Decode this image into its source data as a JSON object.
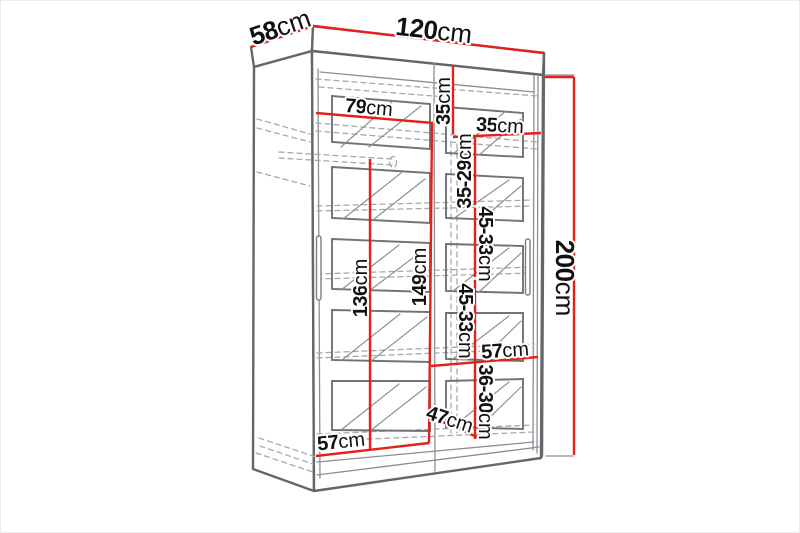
{
  "drawing": {
    "unit": "cm",
    "labels": {
      "depth": {
        "num": "58",
        "unit": "cm"
      },
      "width": {
        "num": "120",
        "unit": "cm"
      },
      "height": {
        "num": "200",
        "unit": "cm"
      },
      "left_interior_width": {
        "num": "79",
        "unit": "cm"
      },
      "top_shelf_height": {
        "num": "35",
        "unit": "cm"
      },
      "right_column_width": {
        "num": "35",
        "unit": "cm"
      },
      "right_gap_1": {
        "num": "35-29",
        "unit": "cm"
      },
      "right_gap_2": {
        "num": "45-33",
        "unit": "cm"
      },
      "right_gap_3": {
        "num": "45-33",
        "unit": "cm"
      },
      "right_interior_width": {
        "num": "57",
        "unit": "cm"
      },
      "right_gap_4": {
        "num": "36-30",
        "unit": "cm"
      },
      "interior_depth": {
        "num": "47",
        "unit": "cm"
      },
      "left_hanging_height": {
        "num": "136",
        "unit": "cm"
      },
      "center_hanging_height": {
        "num": "149",
        "unit": "cm"
      },
      "bottom_interior_width": {
        "num": "57",
        "unit": "cm"
      }
    },
    "colors": {
      "dimension_line": "#e3211a",
      "edge": "#63676b",
      "hidden_line": "#a6a9ac",
      "label_text": "#111111"
    }
  }
}
